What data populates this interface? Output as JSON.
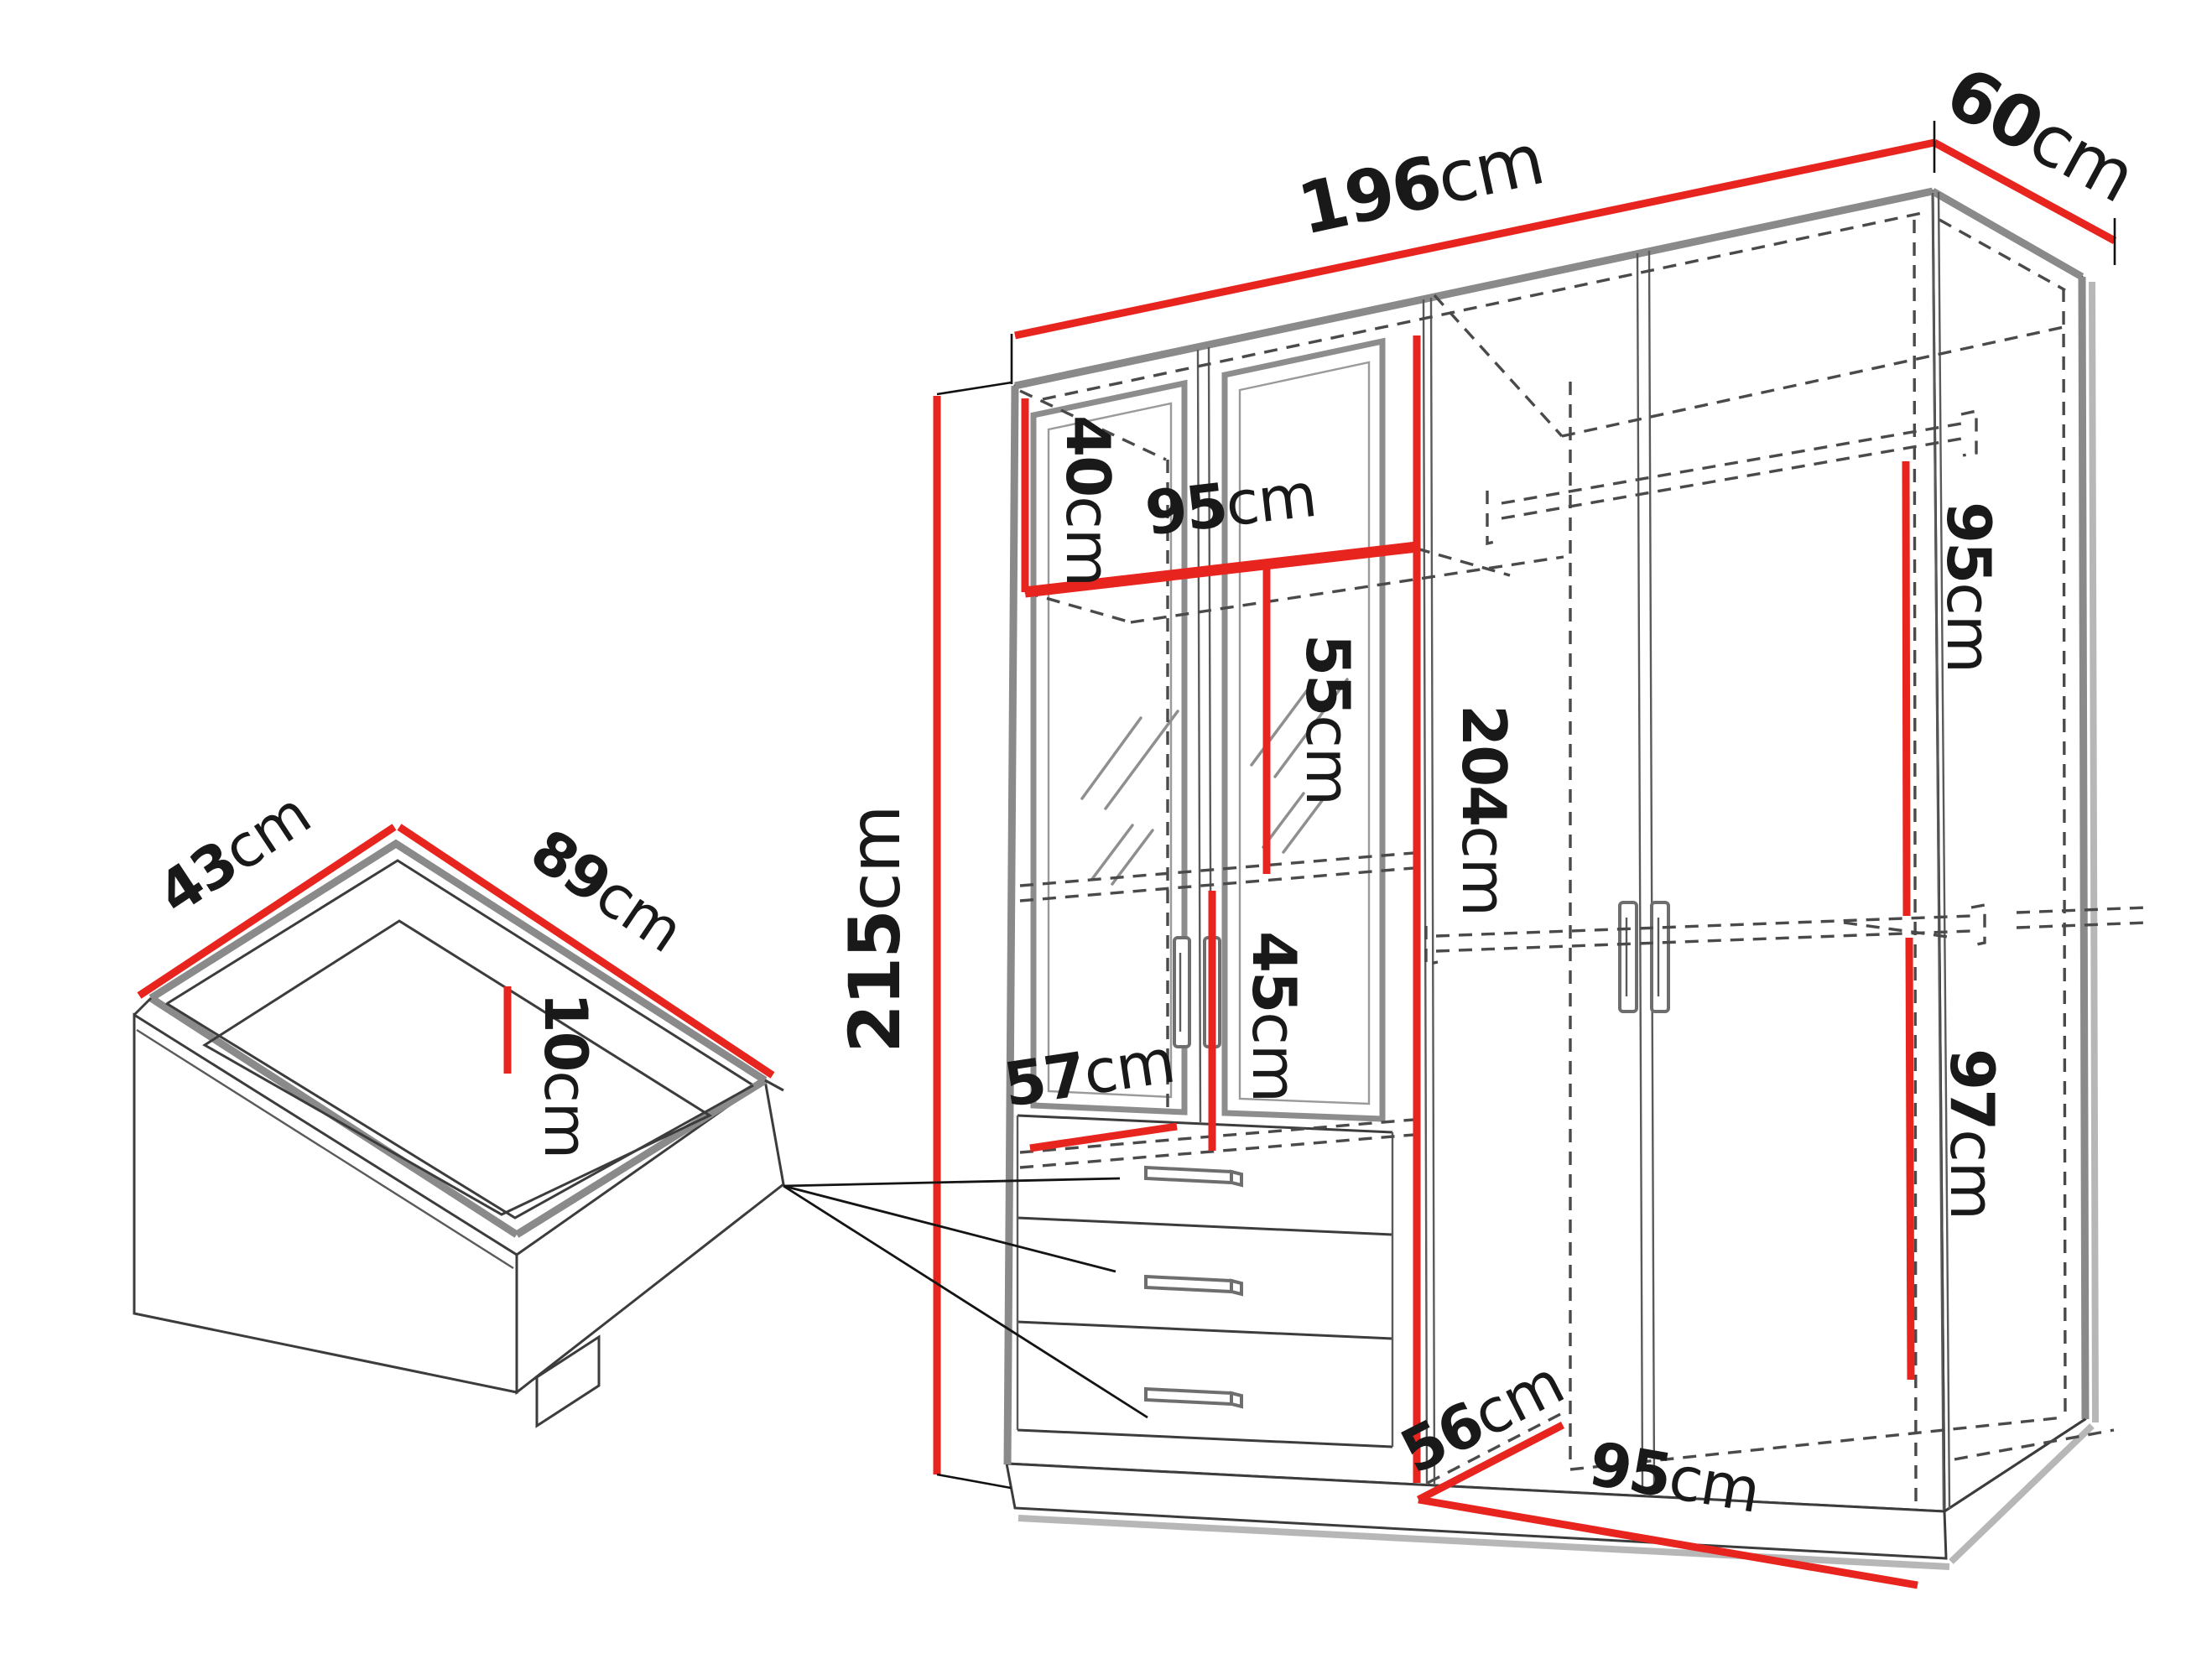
{
  "diagram": {
    "title_semantic": "wardrobe-dimensions-technical-drawing",
    "wardrobe": {
      "width": {
        "value": "196",
        "unit": "cm"
      },
      "depth": {
        "value": "60",
        "unit": "cm"
      },
      "height": {
        "value": "215",
        "unit": "cm"
      },
      "top_shelf_height": {
        "value": "40",
        "unit": "cm"
      },
      "upper_shelf_width": {
        "value": "95",
        "unit": "cm"
      },
      "mirror_section_height": {
        "value": "55",
        "unit": "cm"
      },
      "lower_section_height": {
        "value": "45",
        "unit": "cm"
      },
      "interior_height": {
        "value": "204",
        "unit": "cm"
      },
      "upper_interior_depth": {
        "value": "57",
        "unit": "cm"
      },
      "right_upper_section_height": {
        "value": "95",
        "unit": "cm"
      },
      "right_lower_section_height": {
        "value": "97",
        "unit": "cm"
      },
      "interior_floor_depth": {
        "value": "56",
        "unit": "cm"
      },
      "interior_floor_width": {
        "value": "95",
        "unit": "cm"
      }
    },
    "drawer": {
      "depth": {
        "value": "43",
        "unit": "cm"
      },
      "width": {
        "value": "89",
        "unit": "cm"
      },
      "height": {
        "value": "10",
        "unit": "cm"
      }
    },
    "colors": {
      "dimension_accent": "#e8241f",
      "outline": "#3c3c3c",
      "edge_gray": "#8a8a8a",
      "dashed_line": "#4a4a4a",
      "shadow": "#b7b7b7",
      "background": "#ffffff"
    }
  }
}
